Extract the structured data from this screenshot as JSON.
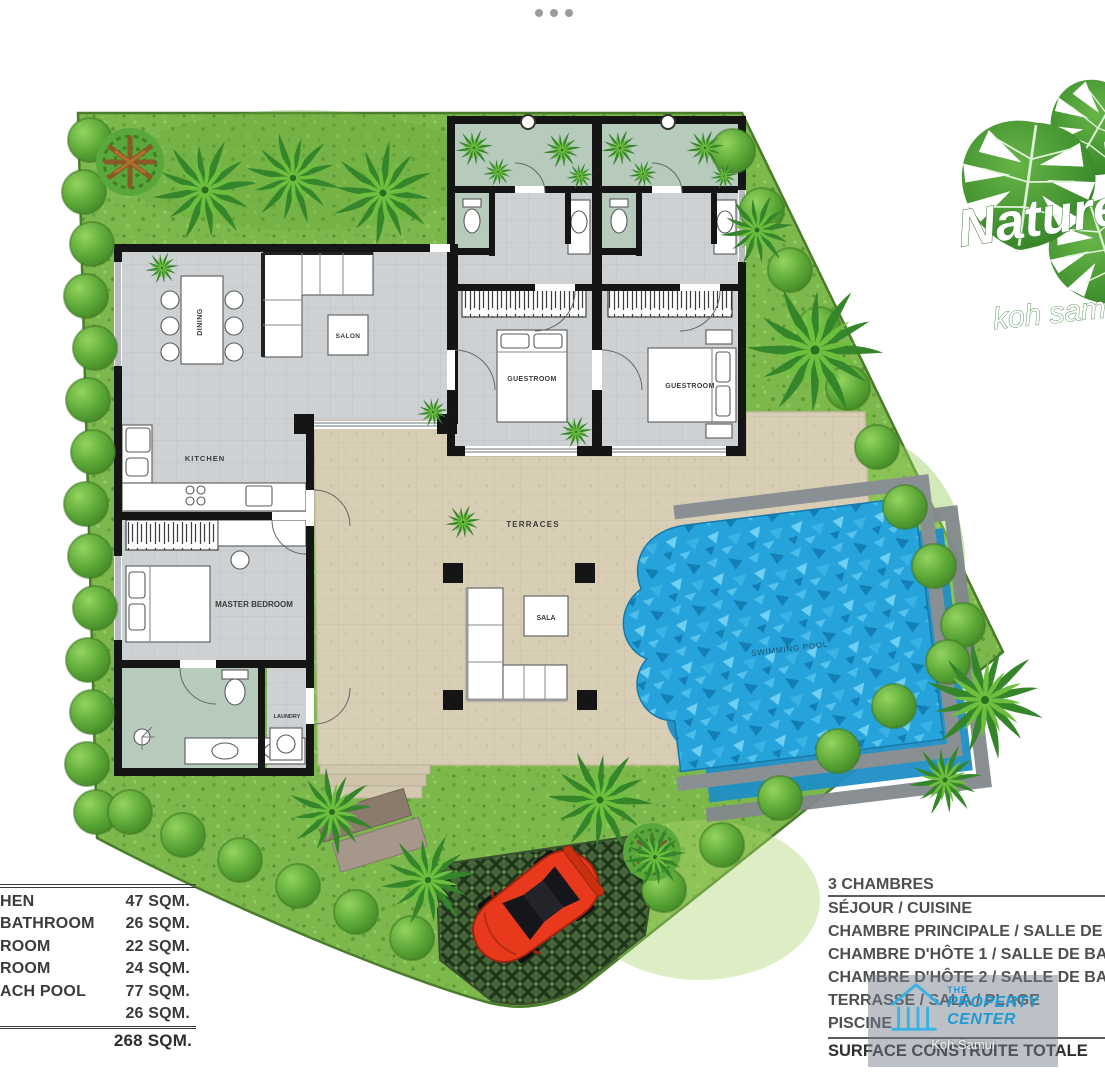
{
  "icons": {
    "carousel_dots": "•••",
    "logo_leaves": "monstera-leaves",
    "watermark_house": "house-columns"
  },
  "colors": {
    "grass": "#7cb84c",
    "grass_edge": "#4a7d2b",
    "pool": "#27a3dc",
    "pool_echo": "#1f8fc6",
    "terrace": "#d8cdb5",
    "floor": "#cdd1d3",
    "bath_floor": "#b7cbbd",
    "courtyard": "#b7cbbd",
    "wall": "#151515",
    "car": "#e8391d",
    "watermark_blue": "#1f9ad2",
    "logo_text": "#ffffff"
  },
  "logo": {
    "line1": "Nature",
    "line2": "koh samui"
  },
  "plan": {
    "rooms": {
      "dining": "DINING",
      "salon": "SALON",
      "kitchen": "KITCHEN",
      "master_bedroom": "MASTER BEDROOM",
      "laundry": "LAUNDRY",
      "guestroom1": "GUESTROOM",
      "guestroom2": "GUESTROOM",
      "terraces": "TERRACES",
      "sala": "SALA",
      "swimming_pool": "SWIMMING POOL"
    }
  },
  "area_table": {
    "rows": [
      {
        "label": "HEN",
        "value": "47 SQM."
      },
      {
        "label": "BATHROOM",
        "value": "26 SQM."
      },
      {
        "label": "ROOM",
        "value": "22 SQM."
      },
      {
        "label": "ROOM",
        "value": "24 SQM."
      },
      {
        "label": "ACH POOL",
        "value": "77 SQM."
      },
      {
        "label": "",
        "value": "26 SQM."
      }
    ],
    "total": "268 SQM."
  },
  "legend_fr": {
    "title": "3 CHAMBRES",
    "items": [
      "SÉJOUR  / CUISINE",
      "CHAMBRE PRINCIPALE / SALLE DE BAIN",
      "CHAMBRE D'HÔTE 1 / SALLE DE BAIN",
      "CHAMBRE D'HÔTE 2 / SALLE DE BAIN",
      "TERRASSE / SALA / PLAGE",
      "PISCINE"
    ],
    "total": "SURFACE CONSTRUITE TOTALE"
  },
  "watermark": {
    "line1": "THE",
    "line2": "PROPERTY",
    "line3": "CENTER",
    "line4": "Koh Samui"
  }
}
